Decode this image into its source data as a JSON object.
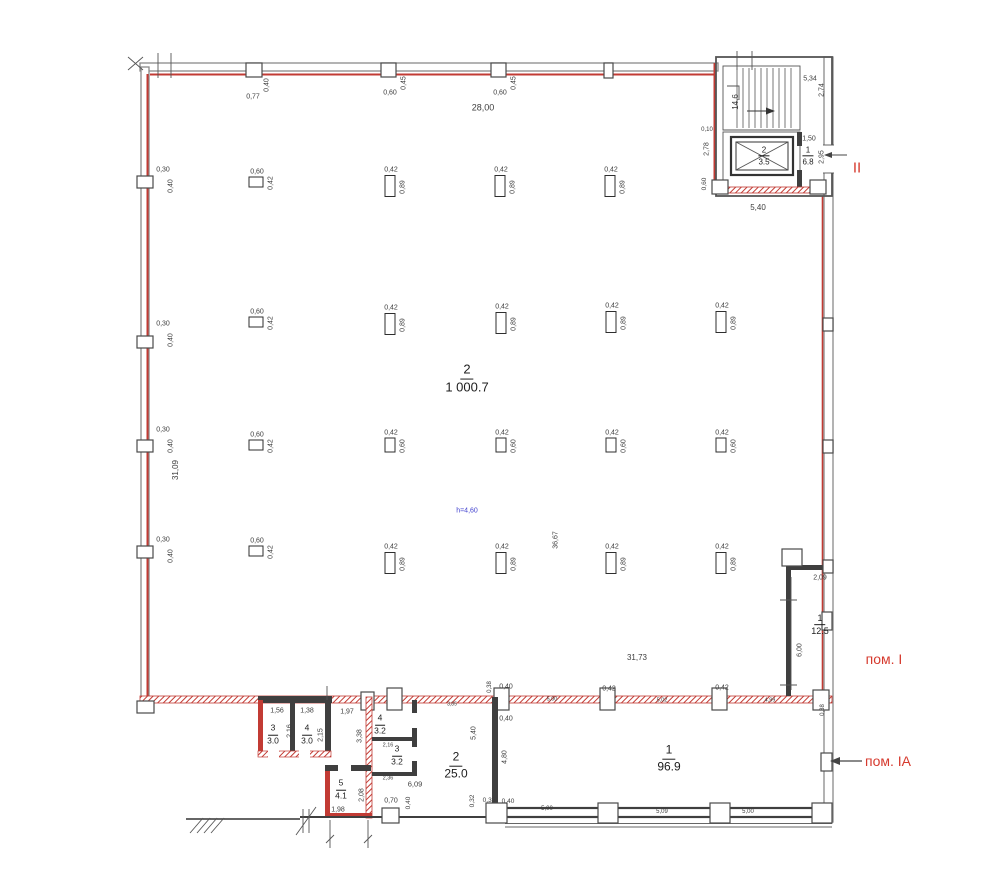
{
  "colors": {
    "wall_red": "#c23b34",
    "wall_dark": "#3f3f3f",
    "dim_text": "#3d3d3d",
    "red_label": "#d63a2e",
    "blue_note": "#4343cf"
  },
  "plan": {
    "red_zone_labels": [
      {
        "text": "II",
        "x": 857,
        "y": 168,
        "size": 15
      },
      {
        "text": "пом. I",
        "x": 884,
        "y": 659,
        "size": 14
      },
      {
        "text": "пом. IА",
        "x": 888,
        "y": 761,
        "size": 14
      }
    ],
    "height_note": {
      "text": "h=4,60",
      "x": 467,
      "y": 511,
      "size": 7
    },
    "rooms": [
      {
        "number": "2",
        "area": "1 000.7",
        "x": 467,
        "y": 379,
        "size": 13
      },
      {
        "number": "2",
        "area": "3.5",
        "x": 764,
        "y": 156,
        "size": 8
      },
      {
        "number": "1",
        "area": "6.8",
        "x": 808,
        "y": 156,
        "size": 8
      },
      {
        "number": "1",
        "area": "12.5",
        "x": 820,
        "y": 625,
        "size": 9
      },
      {
        "number": "1",
        "area": "96.9",
        "x": 669,
        "y": 759,
        "size": 12
      },
      {
        "number": "2",
        "area": "25.0",
        "x": 456,
        "y": 766,
        "size": 12
      },
      {
        "number": "3",
        "area": "3.0",
        "x": 273,
        "y": 735,
        "size": 8.5
      },
      {
        "number": "4",
        "area": "3.0",
        "x": 307,
        "y": 735,
        "size": 8.5
      },
      {
        "number": "4",
        "area": "3.2",
        "x": 380,
        "y": 725,
        "size": 8.5
      },
      {
        "number": "3",
        "area": "3.2",
        "x": 397,
        "y": 756,
        "size": 8.5
      },
      {
        "number": "5",
        "area": "4.1",
        "x": 341,
        "y": 790,
        "size": 8.5
      }
    ],
    "columns": [
      {
        "x": 256,
        "y": 182,
        "w": 13,
        "h": 9,
        "top": "0,60",
        "side": "0,42"
      },
      {
        "x": 256,
        "y": 322,
        "w": 13,
        "h": 9,
        "top": "0,60",
        "side": "0,42"
      },
      {
        "x": 256,
        "y": 445,
        "w": 13,
        "h": 9,
        "top": "0,60",
        "side": "0,42"
      },
      {
        "x": 256,
        "y": 551,
        "w": 13,
        "h": 9,
        "top": "0,60",
        "side": "0,42"
      },
      {
        "x": 390,
        "y": 186,
        "w": 9,
        "h": 20,
        "top": "0,42",
        "side": "0,89"
      },
      {
        "x": 500,
        "y": 186,
        "w": 9,
        "h": 20,
        "top": "0,42",
        "side": "0,89"
      },
      {
        "x": 610,
        "y": 186,
        "w": 9,
        "h": 20,
        "top": "0,42",
        "side": "0,89"
      },
      {
        "x": 390,
        "y": 324,
        "w": 9,
        "h": 20,
        "top": "0,42",
        "side": "0,89"
      },
      {
        "x": 501,
        "y": 323,
        "w": 9,
        "h": 20,
        "top": "0,42",
        "side": "0,89"
      },
      {
        "x": 611,
        "y": 322,
        "w": 9,
        "h": 20,
        "top": "0,42",
        "side": "0,89"
      },
      {
        "x": 721,
        "y": 322,
        "w": 9,
        "h": 20,
        "top": "0,42",
        "side": "0,89"
      },
      {
        "x": 390,
        "y": 445,
        "w": 9,
        "h": 13,
        "top": "0,42",
        "side": "0,60"
      },
      {
        "x": 501,
        "y": 445,
        "w": 9,
        "h": 13,
        "top": "0,42",
        "side": "0,60"
      },
      {
        "x": 611,
        "y": 445,
        "w": 9,
        "h": 13,
        "top": "0,42",
        "side": "0,60"
      },
      {
        "x": 721,
        "y": 445,
        "w": 9,
        "h": 13,
        "top": "0,42",
        "side": "0,60"
      },
      {
        "x": 390,
        "y": 563,
        "w": 9,
        "h": 20,
        "top": "0,42",
        "side": "0,89"
      },
      {
        "x": 501,
        "y": 563,
        "w": 9,
        "h": 20,
        "top": "0,42",
        "side": "0,89"
      },
      {
        "x": 611,
        "y": 563,
        "w": 9,
        "h": 20,
        "top": "0,42",
        "side": "0,89"
      },
      {
        "x": 721,
        "y": 563,
        "w": 9,
        "h": 20,
        "top": "0,42",
        "side": "0,89"
      }
    ],
    "dims": [
      {
        "t": "0,77",
        "x": 253,
        "y": 97,
        "r": 1,
        "s": 7
      },
      {
        "t": "0,40",
        "x": 267,
        "y": 85,
        "r": 1,
        "rot": true,
        "s": 7
      },
      {
        "t": "0,60",
        "x": 390,
        "y": 93,
        "s": 7
      },
      {
        "t": "0,45",
        "x": 404,
        "y": 83,
        "rot": true,
        "s": 7
      },
      {
        "t": "0,60",
        "x": 500,
        "y": 93,
        "s": 7
      },
      {
        "t": "0,45",
        "x": 514,
        "y": 83,
        "rot": true,
        "s": 7
      },
      {
        "t": "28,00",
        "x": 483,
        "y": 108,
        "s": 9
      },
      {
        "t": "5,34",
        "x": 810,
        "y": 79,
        "s": 7
      },
      {
        "t": "2,74",
        "x": 822,
        "y": 90,
        "rot": true,
        "s": 7
      },
      {
        "t": "14,6",
        "x": 736,
        "y": 102,
        "rot": true,
        "s": 8
      },
      {
        "t": "0,10",
        "x": 707,
        "y": 130,
        "s": 6
      },
      {
        "t": "2,78",
        "x": 707,
        "y": 149,
        "rot": true,
        "s": 7
      },
      {
        "t": "1,50",
        "x": 809,
        "y": 139,
        "s": 7
      },
      {
        "t": "2,95",
        "x": 822,
        "y": 157,
        "rot": true,
        "s": 7
      },
      {
        "t": "0,60",
        "x": 705,
        "y": 184,
        "rot": true,
        "s": 6.5
      },
      {
        "t": "5,40",
        "x": 758,
        "y": 208,
        "s": 8
      },
      {
        "t": "0,30",
        "x": 163,
        "y": 170,
        "s": 7
      },
      {
        "t": "0,40",
        "x": 171,
        "y": 186,
        "rot": true,
        "s": 7
      },
      {
        "t": "0,30",
        "x": 163,
        "y": 324,
        "s": 7
      },
      {
        "t": "0,40",
        "x": 171,
        "y": 340,
        "rot": true,
        "s": 7
      },
      {
        "t": "0,30",
        "x": 163,
        "y": 430,
        "s": 7
      },
      {
        "t": "0,40",
        "x": 171,
        "y": 446,
        "rot": true,
        "s": 7
      },
      {
        "t": "0,30",
        "x": 163,
        "y": 540,
        "s": 7
      },
      {
        "t": "0,40",
        "x": 171,
        "y": 556,
        "rot": true,
        "s": 7
      },
      {
        "t": "31,09",
        "x": 176,
        "y": 470,
        "rot": true,
        "s": 8
      },
      {
        "t": "36,67",
        "x": 556,
        "y": 540,
        "rot": true,
        "s": 7
      },
      {
        "t": "31,73",
        "x": 637,
        "y": 658,
        "s": 8
      },
      {
        "t": "2,09",
        "x": 820,
        "y": 578,
        "s": 7
      },
      {
        "t": "6,00",
        "x": 800,
        "y": 650,
        "rot": true,
        "s": 7
      },
      {
        "t": "0,38",
        "x": 490,
        "y": 687,
        "rot": true,
        "s": 6
      },
      {
        "t": "0,40",
        "x": 506,
        "y": 687,
        "s": 7
      },
      {
        "t": "0,42",
        "x": 609,
        "y": 689,
        "s": 7
      },
      {
        "t": "0,42",
        "x": 722,
        "y": 688,
        "s": 7
      },
      {
        "t": "5,00",
        "x": 552,
        "y": 700,
        "s": 5.5
      },
      {
        "t": "5,02",
        "x": 662,
        "y": 701,
        "s": 5.5
      },
      {
        "t": "4,99",
        "x": 770,
        "y": 701,
        "s": 5.5
      },
      {
        "t": "3,85",
        "x": 452,
        "y": 705,
        "s": 5
      },
      {
        "t": "1,56",
        "x": 277,
        "y": 711,
        "s": 7
      },
      {
        "t": "1,38",
        "x": 307,
        "y": 711,
        "s": 7
      },
      {
        "t": "1,97",
        "x": 347,
        "y": 712,
        "s": 7
      },
      {
        "t": "2,16",
        "x": 290,
        "y": 731,
        "rot": true,
        "s": 7
      },
      {
        "t": "2,15",
        "x": 321,
        "y": 735,
        "rot": true,
        "s": 7
      },
      {
        "t": "3,38",
        "x": 360,
        "y": 736,
        "rot": true,
        "s": 7
      },
      {
        "t": "2,16",
        "x": 388,
        "y": 746,
        "s": 5.5
      },
      {
        "t": "2,36",
        "x": 388,
        "y": 779,
        "s": 5.5
      },
      {
        "t": "1,98",
        "x": 338,
        "y": 810,
        "s": 7
      },
      {
        "t": "2,08",
        "x": 362,
        "y": 795,
        "rot": true,
        "s": 7
      },
      {
        "t": "6,09",
        "x": 415,
        "y": 784,
        "s": 7.5
      },
      {
        "t": "0,70",
        "x": 391,
        "y": 801,
        "s": 7
      },
      {
        "t": "0,40",
        "x": 409,
        "y": 803,
        "rot": true,
        "s": 6.5
      },
      {
        "t": "5,40",
        "x": 474,
        "y": 733,
        "rot": true,
        "s": 7
      },
      {
        "t": "0,32",
        "x": 473,
        "y": 801,
        "rot": true,
        "s": 6.5
      },
      {
        "t": "0,35",
        "x": 489,
        "y": 801,
        "s": 6.5
      },
      {
        "t": "0,40",
        "x": 508,
        "y": 802,
        "s": 6.5
      },
      {
        "t": "0,40",
        "x": 506,
        "y": 719,
        "s": 7
      },
      {
        "t": "4,80",
        "x": 505,
        "y": 757,
        "rot": true,
        "s": 7
      },
      {
        "t": "5,00",
        "x": 547,
        "y": 809,
        "s": 6
      },
      {
        "t": "5,09",
        "x": 662,
        "y": 812,
        "s": 6
      },
      {
        "t": "5,00",
        "x": 748,
        "y": 812,
        "s": 6
      },
      {
        "t": "0,38",
        "x": 823,
        "y": 710,
        "rot": true,
        "s": 6
      }
    ]
  }
}
